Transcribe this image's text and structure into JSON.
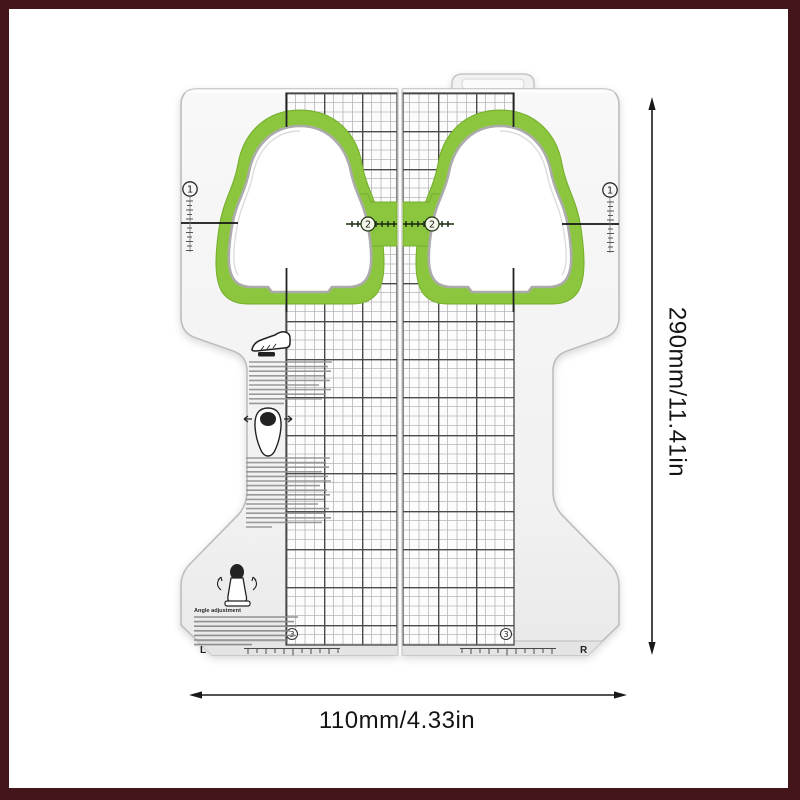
{
  "scene": {
    "type": "product-photo",
    "frame_color": "#431419",
    "background_color": "#ffffff"
  },
  "annotations": {
    "height_dimension": "290mm/11.41in",
    "width_dimension": "110mm/4.33in",
    "arrow_color": "#1a1a1a"
  },
  "tool": {
    "kind": "bike-pedal-cleat-alignment-plate",
    "markers": {
      "step1": "1",
      "step2": "2",
      "step3": "3"
    },
    "foot_marks": {
      "left": "L",
      "right": "R"
    },
    "angle_section_title": "Angle adjustment",
    "colors": {
      "body": "#f4f4f4",
      "accent_green": "#8cc63e",
      "accent_green_dark": "#74ad2c",
      "grid_line": "#b6b6b6",
      "grid_strong": "#4a4a4a"
    },
    "icons": [
      "hang-tab",
      "shoe-side-icon",
      "shoe-bottom-icon",
      "leg-rear-icon",
      "circled-step-markers",
      "ruler-ticks"
    ]
  }
}
